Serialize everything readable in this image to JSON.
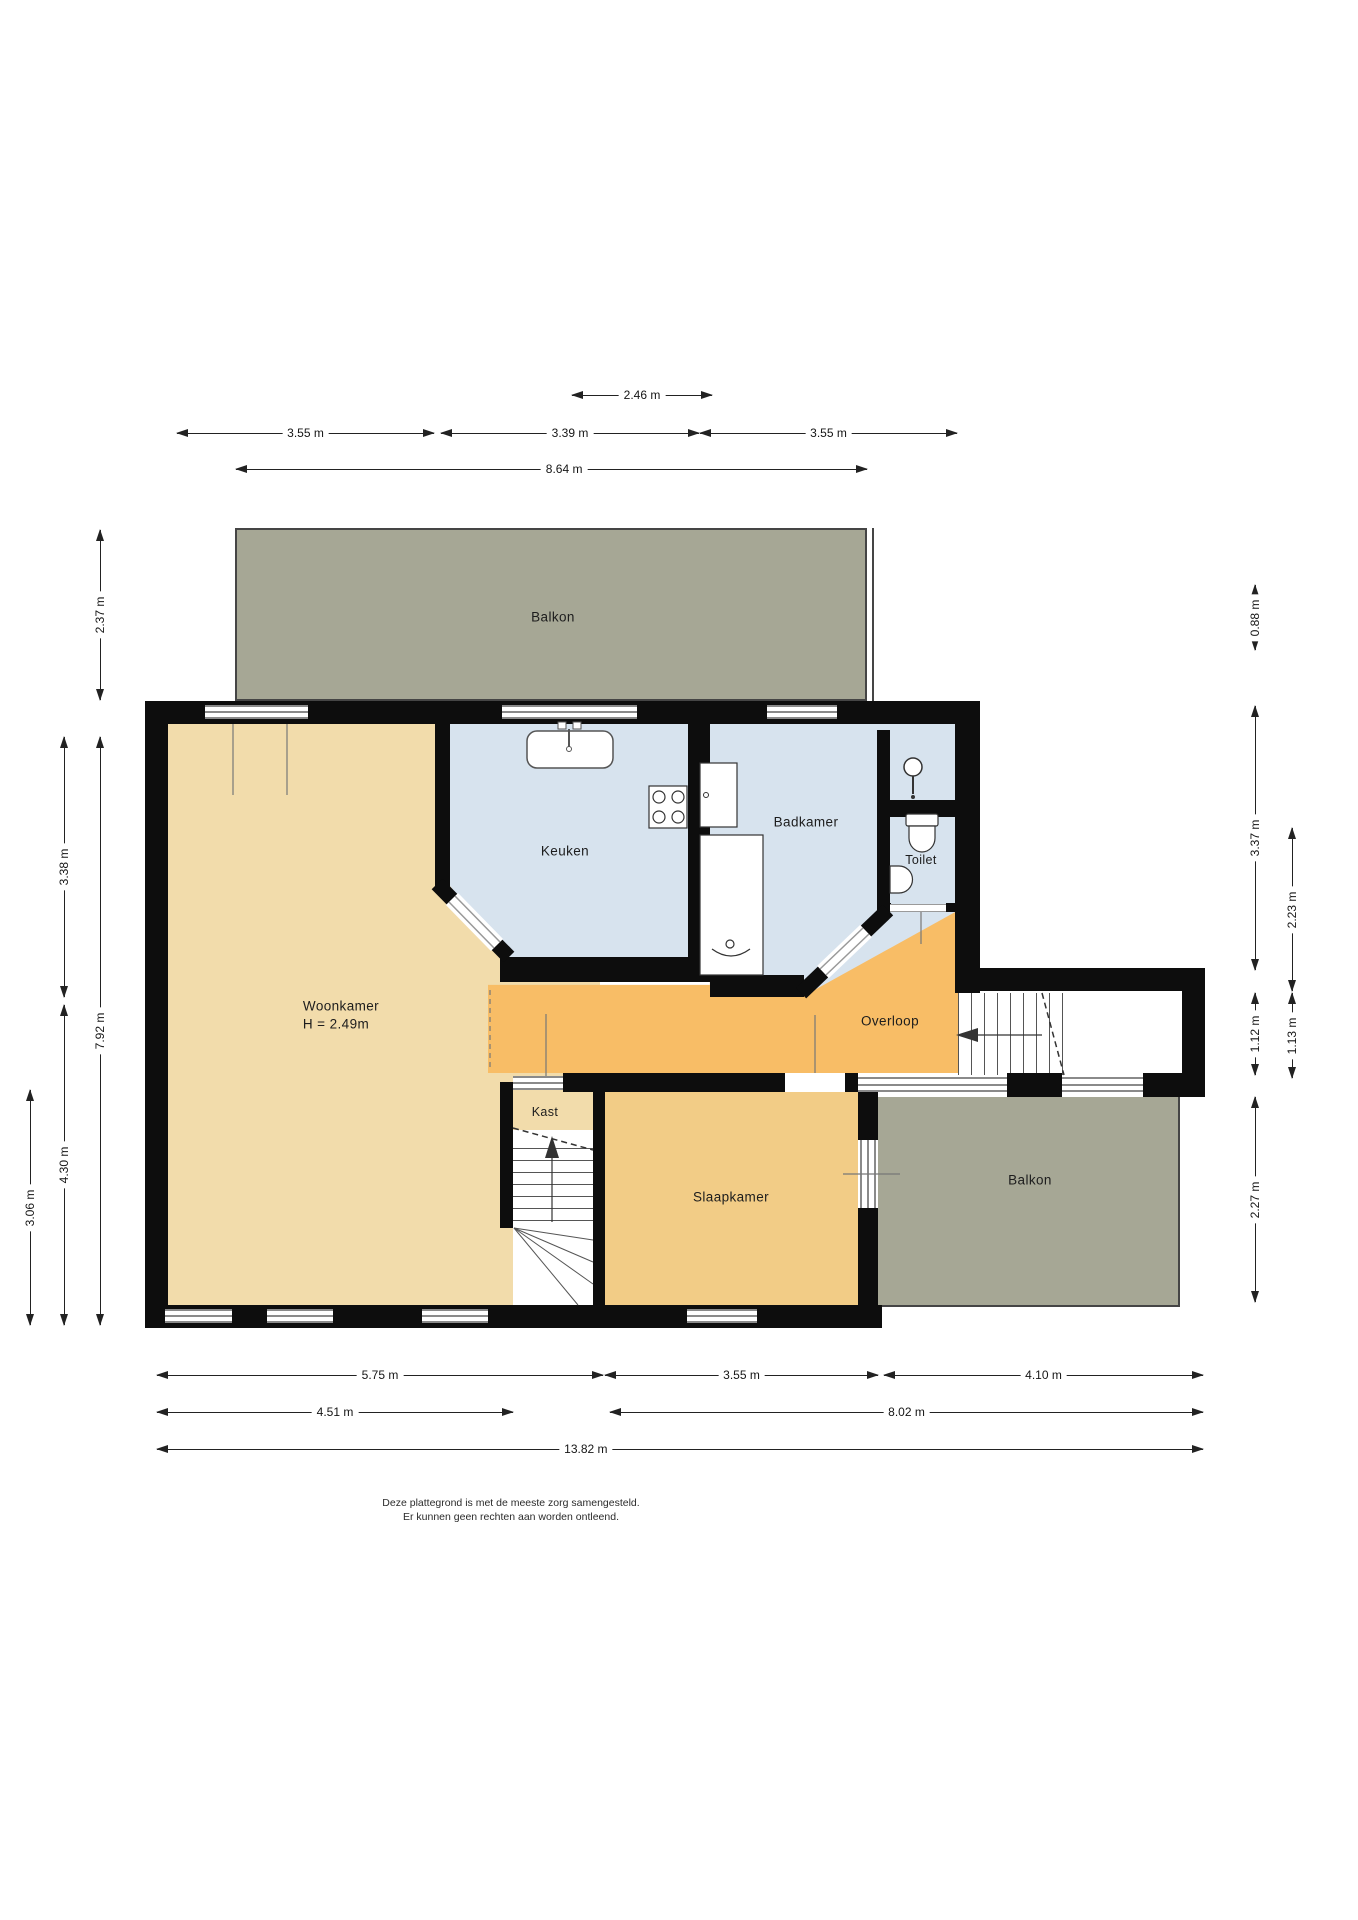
{
  "rooms": {
    "balkon_top": {
      "label": "Balkon"
    },
    "keuken": {
      "label": "Keuken"
    },
    "badkamer": {
      "label": "Badkamer"
    },
    "toilet": {
      "label": "Toilet"
    },
    "woonkamer": {
      "label": "Woonkamer",
      "height_note": "H = 2.49m"
    },
    "overloop": {
      "label": "Overloop"
    },
    "kast": {
      "label": "Kast"
    },
    "slaapkamer": {
      "label": "Slaapkamer"
    },
    "balkon_right": {
      "label": "Balkon"
    }
  },
  "dims": {
    "d246": "2.46 m",
    "d355a": "3.55 m",
    "d339": "3.39 m",
    "d355b": "3.55 m",
    "d864": "8.64 m",
    "d575": "5.75 m",
    "d355c": "3.55 m",
    "d410": "4.10 m",
    "d451": "4.51 m",
    "d802": "8.02 m",
    "d1382": "13.82 m",
    "d237": "2.37 m",
    "d792": "7.92 m",
    "d338": "3.38 m",
    "d430": "4.30 m",
    "d306": "3.06 m",
    "d088": "0.88 m",
    "d337": "3.37 m",
    "d223": "2.23 m",
    "d112": "1.12 m",
    "d113": "1.13 m",
    "d227": "2.27 m"
  },
  "disclaimer": {
    "line1": "Deze plattegrond is met de meeste zorg samengesteld.",
    "line2": "Er kunnen geen rechten aan worden ontleend."
  },
  "colors": {
    "balcony": "#a6a795",
    "living": "#f2dcab",
    "wet": "#d7e3ee",
    "hall": "#f8bd66",
    "bedroom": "#f2cc86",
    "wall": "#0d0d0d"
  }
}
